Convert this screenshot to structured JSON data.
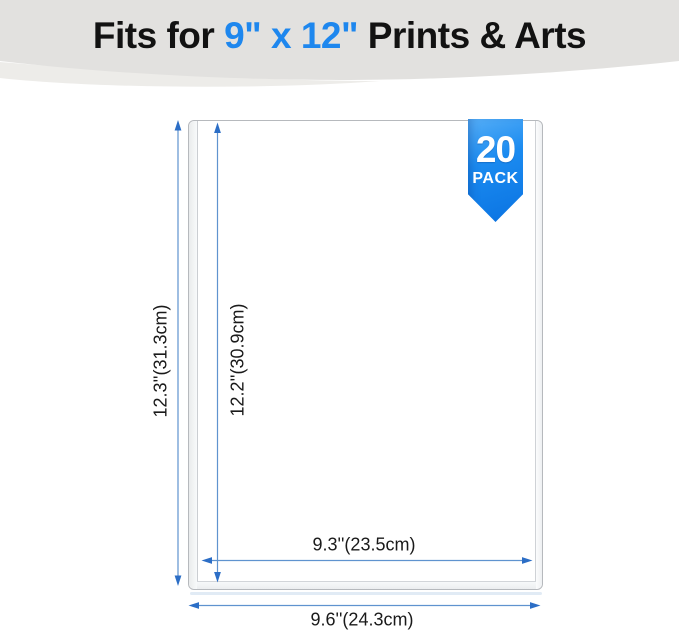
{
  "header": {
    "title_prefix": "Fits for ",
    "title_highlight": "9\" x 12\"",
    "title_suffix": " Prints & Arts",
    "highlight_color": "#1e87ee",
    "banner_color": "#e2e1df",
    "banner_shadow_color": "#edece9"
  },
  "badge": {
    "count": "20",
    "label": "PACK",
    "color_top": "#55aef7",
    "color_bottom": "#0a73e2"
  },
  "dimensions": {
    "outer_height": "12.3''(31.3cm)",
    "inner_height": "12.2''(30.9cm)",
    "inner_width": "9.3''(23.5cm)",
    "outer_width": "9.6''(24.3cm)",
    "arrow_head_color": "#2c6ec6",
    "arrow_line_color": "#5f93cf"
  }
}
